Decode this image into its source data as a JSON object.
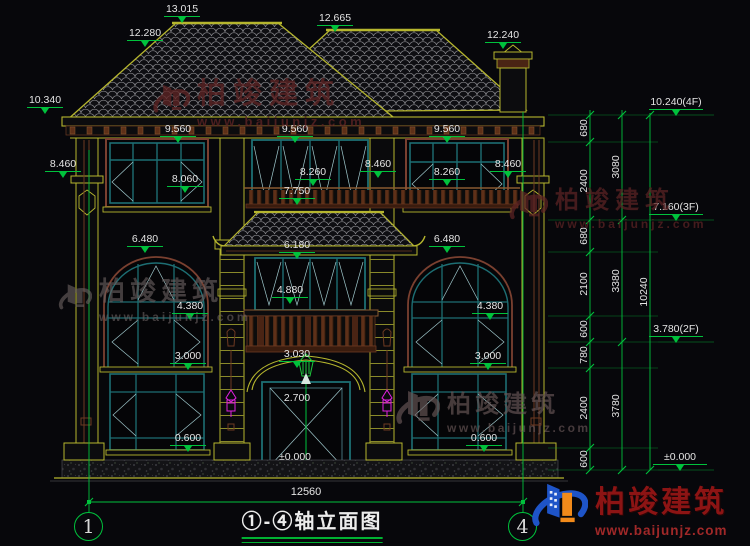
{
  "drawing": {
    "title": "①-④轴立面图",
    "overall_width_dim": "12560",
    "axis_bubbles": {
      "left": "1",
      "right": "4"
    },
    "watermark": {
      "brand": "柏竣建筑",
      "url": "www.baijunjz.com"
    },
    "colors": {
      "line_yellow": "#b6b62e",
      "dim_green": "#00c23c",
      "window_teal": "#1d6e73",
      "accent_brown": "#6e3a22",
      "lamp_magenta": "#e020e0",
      "watermark_red": "#5e2424",
      "logo_blue": "#1e54c8",
      "logo_orange": "#f28a1a"
    },
    "elevation_labels": [
      {
        "t": "13.015",
        "x": 182,
        "y": 4
      },
      {
        "t": "12.280",
        "x": 145,
        "y": 28
      },
      {
        "t": "12.665",
        "x": 335,
        "y": 13
      },
      {
        "t": "12.240",
        "x": 503,
        "y": 30
      },
      {
        "t": "10.340",
        "x": 45,
        "y": 95
      },
      {
        "t": "9.560",
        "x": 178,
        "y": 124
      },
      {
        "t": "9.560",
        "x": 295,
        "y": 124
      },
      {
        "t": "9.560",
        "x": 447,
        "y": 124
      },
      {
        "t": "8.460",
        "x": 63,
        "y": 159
      },
      {
        "t": "8.460",
        "x": 378,
        "y": 159
      },
      {
        "t": "8.460",
        "x": 508,
        "y": 159
      },
      {
        "t": "8.060",
        "x": 185,
        "y": 174
      },
      {
        "t": "8.260",
        "x": 313,
        "y": 167
      },
      {
        "t": "8.260",
        "x": 447,
        "y": 167
      },
      {
        "t": "7.750",
        "x": 297,
        "y": 186
      },
      {
        "t": "6.480",
        "x": 145,
        "y": 234
      },
      {
        "t": "6.180",
        "x": 297,
        "y": 240
      },
      {
        "t": "6.480",
        "x": 447,
        "y": 234
      },
      {
        "t": "4.880",
        "x": 290,
        "y": 285
      },
      {
        "t": "4.380",
        "x": 190,
        "y": 301
      },
      {
        "t": "4.380",
        "x": 490,
        "y": 301
      },
      {
        "t": "3.030",
        "x": 297,
        "y": 349
      },
      {
        "t": "3.000",
        "x": 188,
        "y": 351
      },
      {
        "t": "3.000",
        "x": 488,
        "y": 351
      },
      {
        "t": "2.700",
        "x": 297,
        "y": 393,
        "cls": "notri"
      },
      {
        "t": "0.600",
        "x": 188,
        "y": 433
      },
      {
        "t": "0.600",
        "x": 484,
        "y": 433
      },
      {
        "t": "±0.000",
        "x": 295,
        "y": 452,
        "cls": "notri"
      },
      {
        "t": "10.240(4F)",
        "x": 676,
        "y": 97,
        "cls": "wide"
      },
      {
        "t": "7.160(3F)",
        "x": 676,
        "y": 202,
        "cls": "wide"
      },
      {
        "t": "3.780(2F)",
        "x": 676,
        "y": 324,
        "cls": "wide"
      },
      {
        "t": "±0.000",
        "x": 680,
        "y": 452,
        "cls": "wide"
      }
    ],
    "segment_dims": [
      {
        "t": "680",
        "x": 584,
        "y": 128
      },
      {
        "t": "2400",
        "x": 584,
        "y": 181
      },
      {
        "t": "680",
        "x": 584,
        "y": 236
      },
      {
        "t": "2100",
        "x": 584,
        "y": 284
      },
      {
        "t": "600",
        "x": 584,
        "y": 329
      },
      {
        "t": "780",
        "x": 584,
        "y": 355
      },
      {
        "t": "2400",
        "x": 584,
        "y": 408
      },
      {
        "t": "600",
        "x": 584,
        "y": 459
      },
      {
        "t": "3080",
        "x": 616,
        "y": 167
      },
      {
        "t": "3380",
        "x": 616,
        "y": 281
      },
      {
        "t": "3780",
        "x": 616,
        "y": 406
      },
      {
        "t": "10240",
        "x": 644,
        "y": 292
      }
    ]
  }
}
